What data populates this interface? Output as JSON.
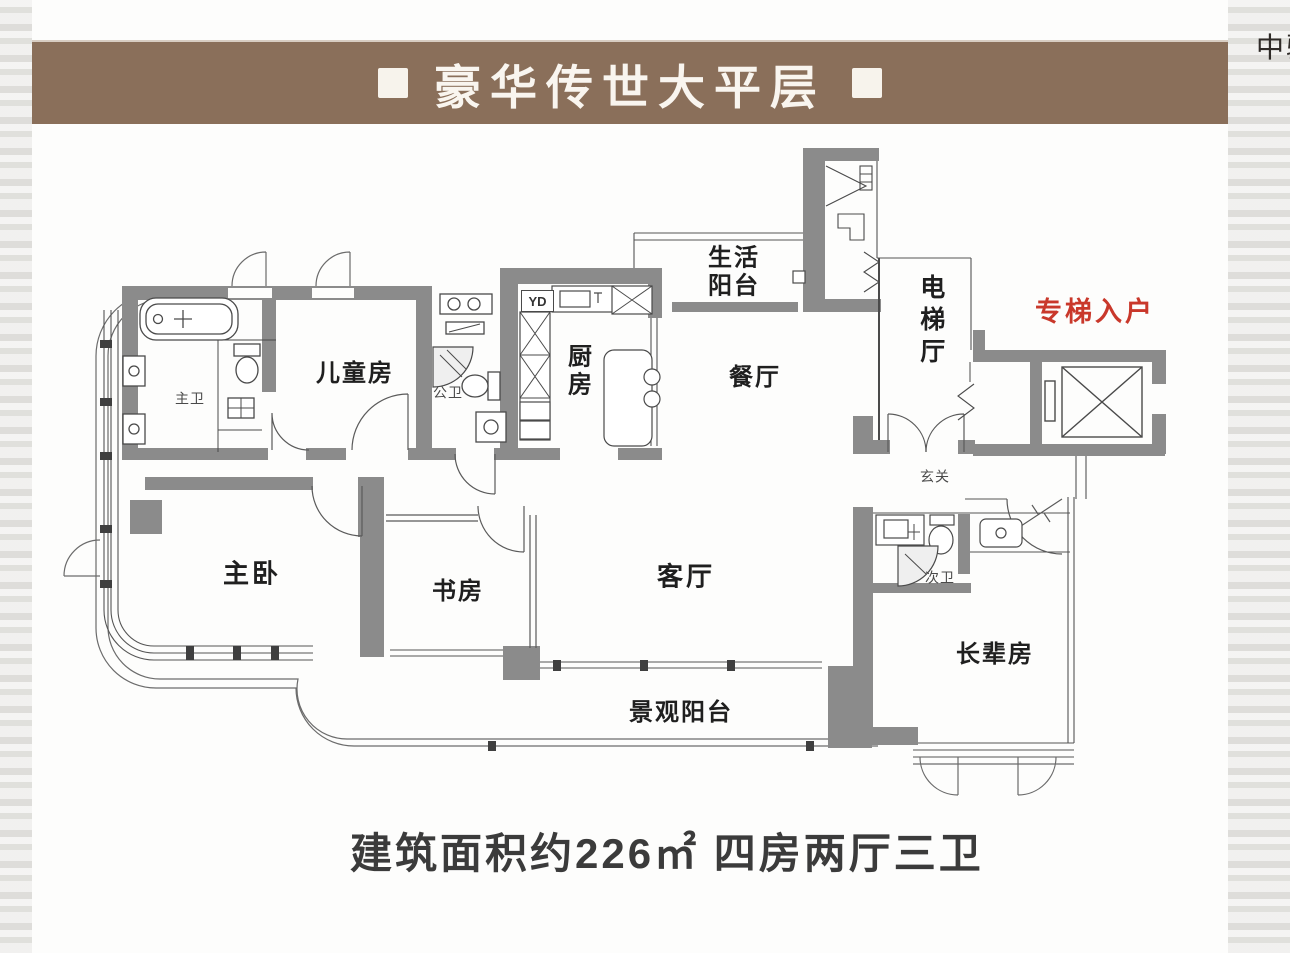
{
  "banner": {
    "title": "豪华传世大平层"
  },
  "watermark": "中骏",
  "caption": "建筑面积约226㎡ 四房两厅三卫",
  "colors": {
    "banner_bg": "#8a6f5a",
    "accent_red": "#c9382b",
    "wall_gray": "#8b8b8b",
    "text_dark": "#1f1f1f"
  },
  "floorplan": {
    "rooms": [
      {
        "id": "master-bath",
        "label": "主卫"
      },
      {
        "id": "kids-room",
        "label": "儿童房"
      },
      {
        "id": "public-bath",
        "label": "公卫"
      },
      {
        "id": "kitchen",
        "label": "厨\n房"
      },
      {
        "id": "service-balcony",
        "label": "生活\n阳台"
      },
      {
        "id": "dining",
        "label": "餐厅"
      },
      {
        "id": "elevator-hall",
        "label": "电梯厅"
      },
      {
        "id": "private-elevator",
        "label": "专梯入户"
      },
      {
        "id": "foyer",
        "label": "玄关"
      },
      {
        "id": "master-bedroom",
        "label": "主卧"
      },
      {
        "id": "study",
        "label": "书房"
      },
      {
        "id": "living-room",
        "label": "客厅"
      },
      {
        "id": "second-bath",
        "label": "次卫"
      },
      {
        "id": "elders-room",
        "label": "长辈房"
      },
      {
        "id": "view-balcony",
        "label": "景观阳台"
      }
    ],
    "annotations": [
      {
        "id": "yd",
        "label": "YD"
      }
    ]
  }
}
